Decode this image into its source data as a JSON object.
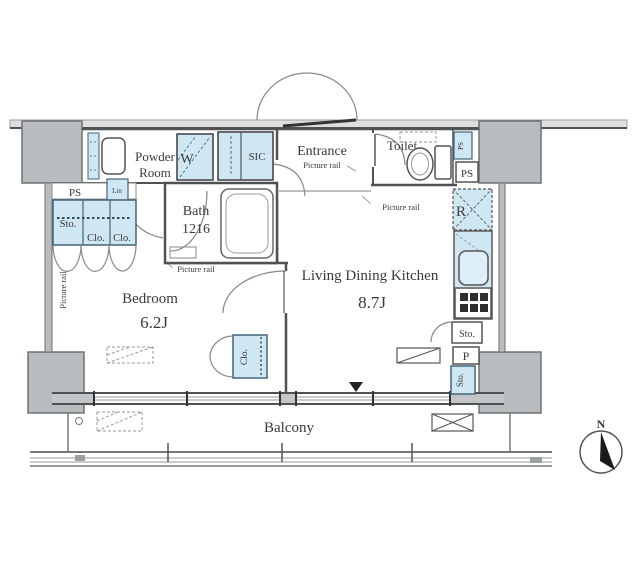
{
  "plan": {
    "rooms": {
      "powder_line1": "Powder",
      "powder_line2": "Room",
      "entrance": "Entrance",
      "toilet": "Toilet",
      "bath": "Bath",
      "bath_size": "1216",
      "bedroom": "Bedroom",
      "bedroom_size": "6.2J",
      "ldk": "Living Dining Kitchen",
      "ldk_size": "8.7J",
      "balcony": "Balcony"
    },
    "fixtures": {
      "washer": "W",
      "sic": "SIC",
      "fridge": "R",
      "pantry": "P",
      "storage": "Sto.",
      "closet": "Clo.",
      "linen": "Lin",
      "pipe_space": "PS"
    },
    "labels": {
      "picture_rail": "Picture rail",
      "north": "N"
    },
    "colors": {
      "fixture_blue": "#cfe6f3",
      "column_gray": "#b9bcbe",
      "wall": "#4f5254"
    }
  }
}
